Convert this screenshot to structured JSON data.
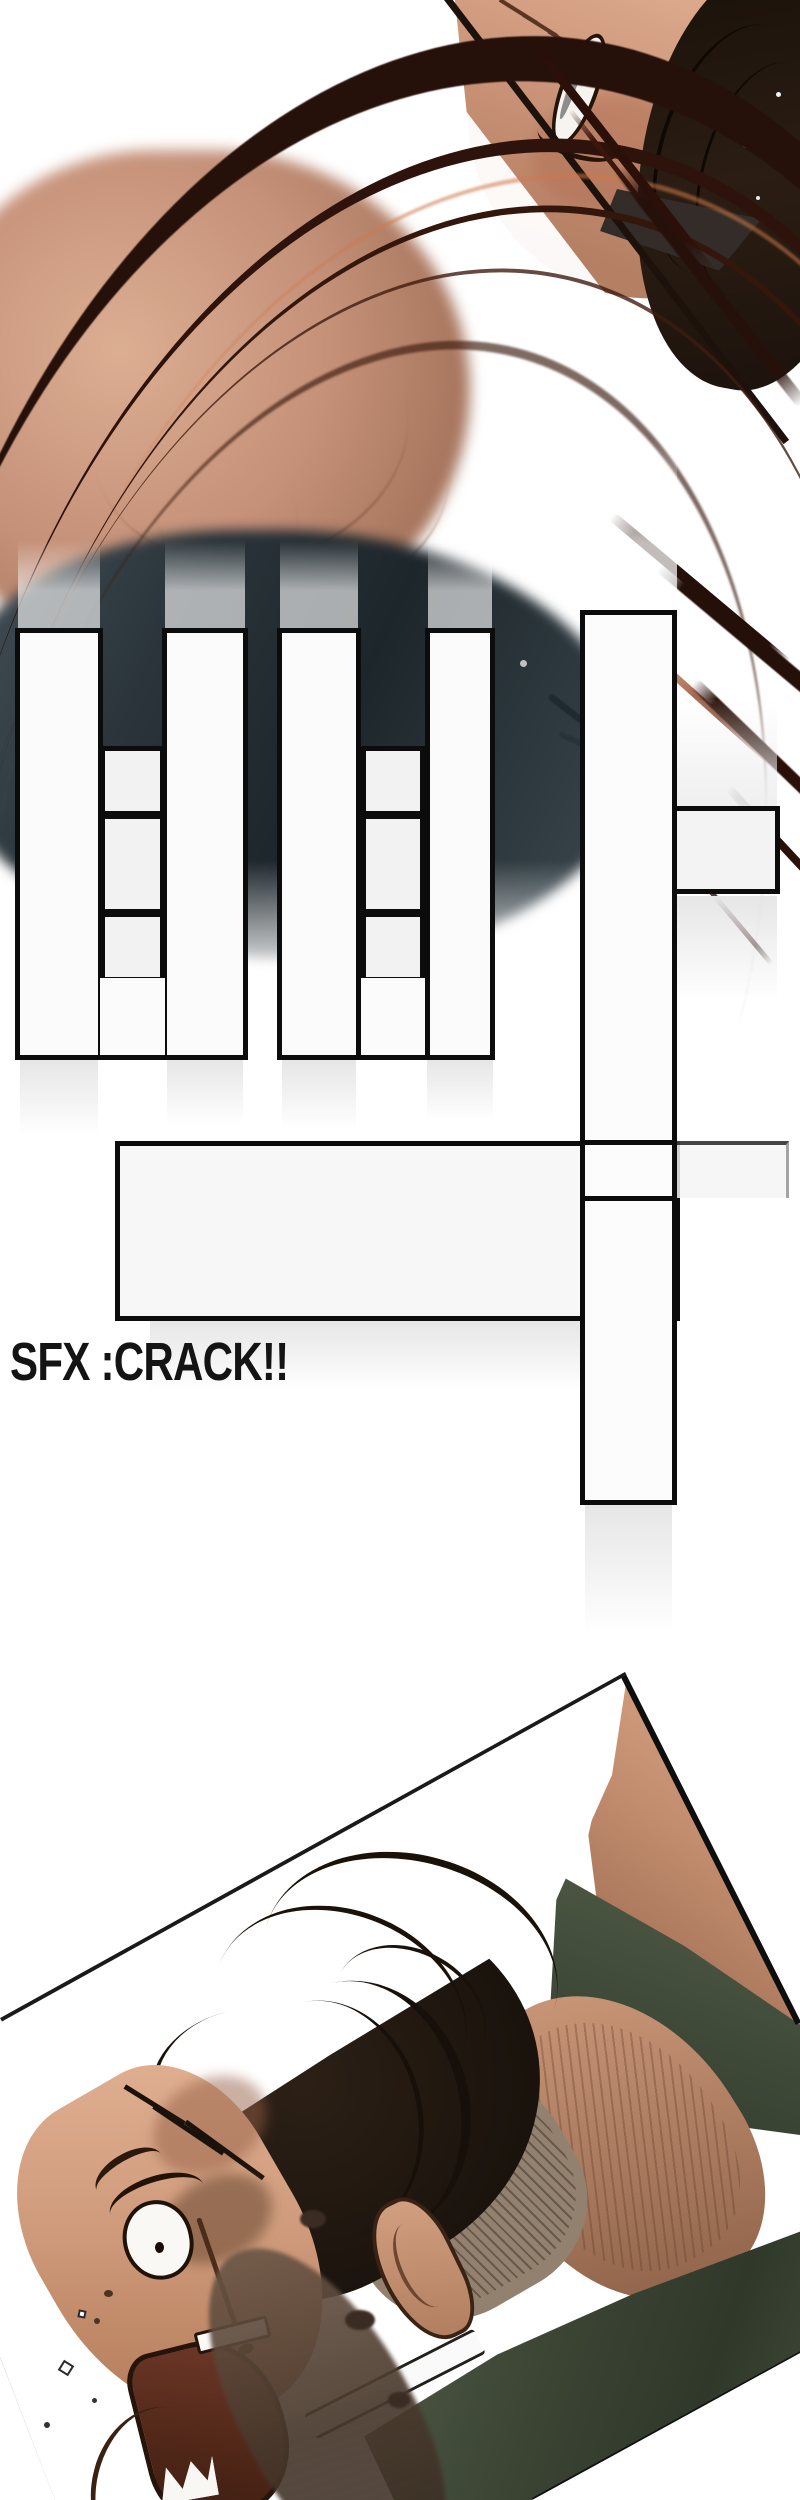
{
  "page": {
    "kind": "webtoon-comic-page",
    "background": "#ffffff"
  },
  "caption": {
    "text": "SFX :CRACK!!",
    "color": "#141414"
  },
  "colors": {
    "sfx_block_fill": "#fbfbfb",
    "sfx_block_outline": "#0c0c0c",
    "speedline_dark": "#26100a",
    "speedline_warm": "#c97a52",
    "skin_light": "#e2b294",
    "skin_mid": "#c48e74",
    "skin_shadow": "#96654f",
    "hair_dark": "#1d150e",
    "shirt_green": "#49523f",
    "dark_mass_teal": "#2a343a",
    "mouth_dark": "#502718",
    "panel_border": "#111111"
  }
}
